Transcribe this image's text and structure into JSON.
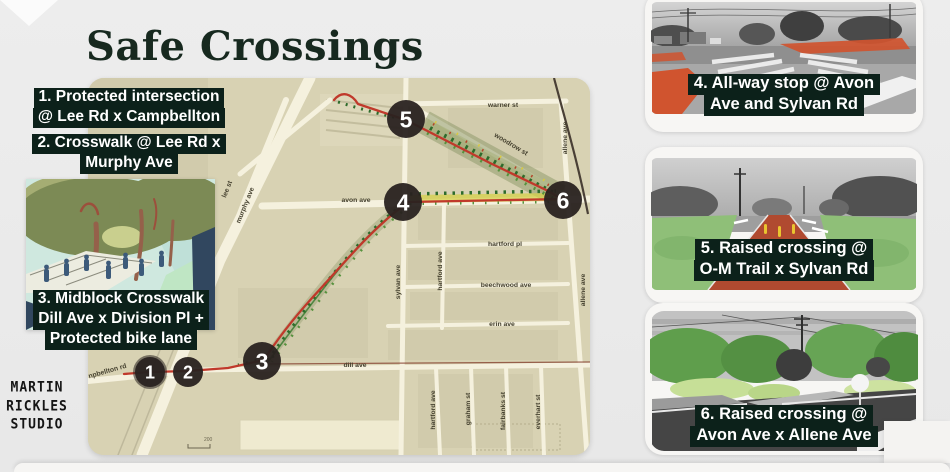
{
  "title": "Safe Crossings",
  "colors": {
    "background": "#ececec",
    "title_green": "#17291f",
    "label_bg": "#0c211a",
    "map_base": "#d8d2b3",
    "road_cream": "#f5f1de",
    "route_red": "#c0392b",
    "trail_green": "#2d6b2b",
    "corridor_olive": "#8a9565",
    "highlight_yellow": "#d6d049",
    "marker_bg": "#292220"
  },
  "annotations": {
    "label1": {
      "lines": [
        "1. Protected intersection",
        "@ Lee Rd x Campbellton"
      ]
    },
    "label2": {
      "lines": [
        "2. Crosswalk @ Lee Rd x",
        "Murphy Ave"
      ]
    },
    "label3": {
      "lines": [
        "3. Midblock Crosswalk",
        "Dill Ave x Division Pl +",
        "Protected bike lane"
      ]
    }
  },
  "map": {
    "markers": [
      "1",
      "2",
      "3",
      "4",
      "5",
      "6"
    ],
    "streets": [
      {
        "label": "lee st"
      },
      {
        "label": "murphy ave"
      },
      {
        "label": "npbellton rd"
      },
      {
        "label": "avon ave"
      },
      {
        "label": "dill ave"
      },
      {
        "label": "warner st"
      },
      {
        "label": "woodrow st"
      },
      {
        "label": "allene ave"
      },
      {
        "label": "allene ave"
      },
      {
        "label": "sylvan ave"
      },
      {
        "label": "hartford ave"
      },
      {
        "label": "hartford pl"
      },
      {
        "label": "beechwood ave"
      },
      {
        "label": "erin ave"
      },
      {
        "label": "hartford ave"
      },
      {
        "label": "graham st"
      },
      {
        "label": "fairbanks st"
      },
      {
        "label": "everhart st"
      }
    ],
    "scale_label": "200"
  },
  "callouts": [
    {
      "lines": [
        "4. All-way stop @ Avon",
        "Ave and Sylvan Rd"
      ]
    },
    {
      "lines": [
        "5. Raised crossing @",
        "O-M Trail x Sylvan Rd"
      ]
    },
    {
      "lines": [
        "6. Raised crossing @",
        "Avon Ave x Allene Ave"
      ]
    }
  ],
  "logo": {
    "lines": [
      "MARTIN",
      "RICKLES",
      "STUDIO"
    ]
  }
}
